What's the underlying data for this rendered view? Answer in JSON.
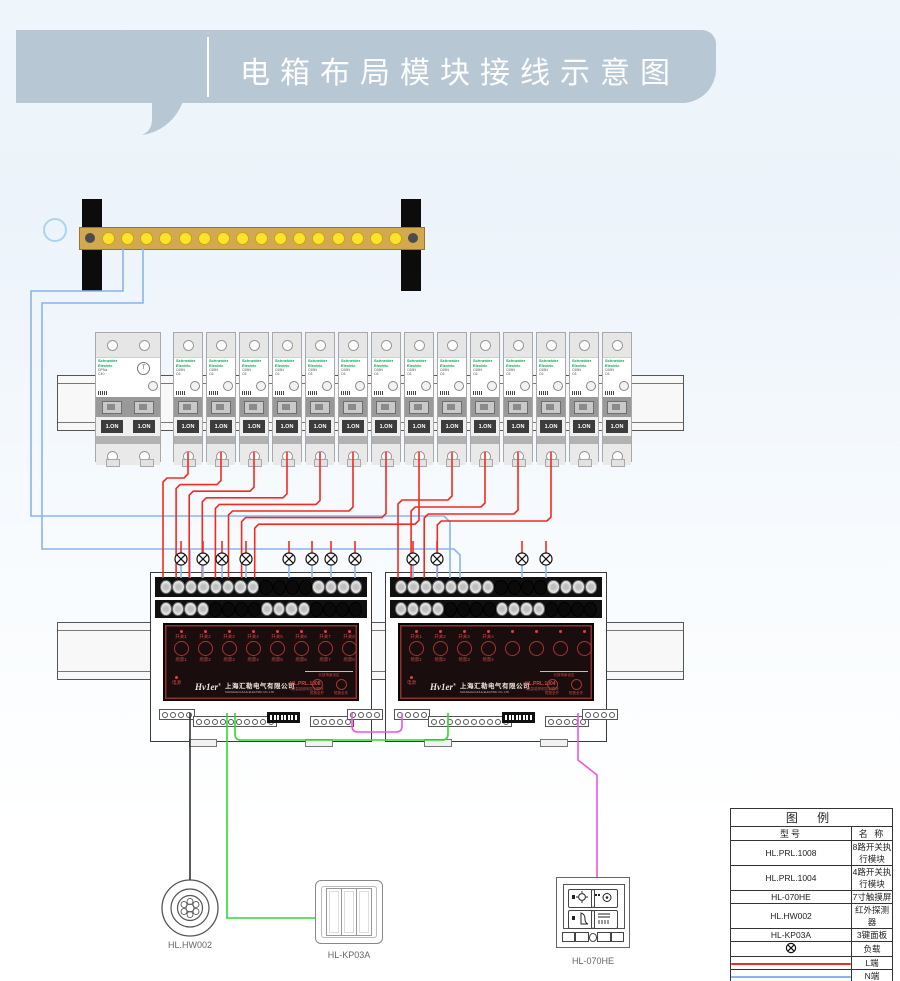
{
  "title": "电箱布局模块接线示意图",
  "colors": {
    "bubble": "#b7c8d4",
    "schneider_green": "#00a651",
    "wire_l": "#f42a20",
    "wire_n": "#8ab4f0",
    "wire_bus": "#2ddc2d",
    "wire_panel": "#ee55e0",
    "wire_sensor": "#333333",
    "busbar": "#d2a851",
    "busbar_dot": "#ffe22e"
  },
  "busbar": {
    "dot_count": 16
  },
  "breakers": {
    "brand_line1": "Schneider",
    "brand_line2": "Electric",
    "main": {
      "model": "DPNa",
      "rating": "C40",
      "toggle": "1.ON",
      "dial": "T"
    },
    "single": {
      "model": "C65N",
      "rating": "C6",
      "toggle": "1.ON"
    },
    "single_count": 14,
    "wired_count": 12
  },
  "modules": [
    {
      "model": "HL.PRL.1008",
      "subtitle": "8路智能照明控制模块",
      "logo": "Hv1er",
      "logo_mark": "®",
      "company_cn": "上海汇勒电气有限公司",
      "company_en": "SHANGHAI HULE ELECTRIC CO.,LTD",
      "power_label": "电源",
      "switch_labels": [
        "开关1",
        "开关2",
        "开关3",
        "开关4",
        "开关5",
        "开关6",
        "开关7",
        "开关8"
      ],
      "scene_labels": [
        "场景1",
        "场景2",
        "场景3",
        "场景4",
        "场景5",
        "场景6",
        "场景7",
        "场景8"
      ],
      "long_press_label": "长按场景设定",
      "all_on_label": "短按全开",
      "all_off_label": "短按全关"
    },
    {
      "model": "HL.PRL.1004",
      "subtitle": "4路智能照明控制模块",
      "logo": "Hv1er",
      "logo_mark": "®",
      "company_cn": "上海汇勒电气有限公司",
      "company_en": "SHANGHAI HULE ELECTRIC CO.,LTD",
      "power_label": "电源",
      "switch_labels": [
        "开关1",
        "开关2",
        "开关3",
        "开关4",
        "",
        "",
        "",
        ""
      ],
      "scene_labels": [
        "场景1",
        "场景2",
        "场景3",
        "场景4",
        "",
        "",
        "",
        ""
      ],
      "long_press_label": "长按场景设定",
      "all_on_label": "短按全开",
      "all_off_label": "短按全关"
    }
  ],
  "devices": [
    {
      "label": "HL.HW002"
    },
    {
      "label": "HL-KP03A"
    },
    {
      "label": "HL-070HE"
    }
  ],
  "legend": {
    "title": "图  例",
    "col_model": "型号",
    "col_name": "名 称",
    "rows": [
      {
        "model": "HL.PRL.1008",
        "name": "8路开关执行模块"
      },
      {
        "model": "HL.PRL.1004",
        "name": "4路开关执行模块"
      },
      {
        "model": "HL-070HE",
        "name": "7寸触摸屏"
      },
      {
        "model": "HL.HW002",
        "name": "红外探测器"
      },
      {
        "model": "HL-KP03A",
        "name": "3键面板"
      },
      {
        "swatch": "load",
        "name": "负载"
      },
      {
        "swatch": "line-red",
        "name": "L端"
      },
      {
        "swatch": "line-blue",
        "name": "N端"
      }
    ]
  }
}
